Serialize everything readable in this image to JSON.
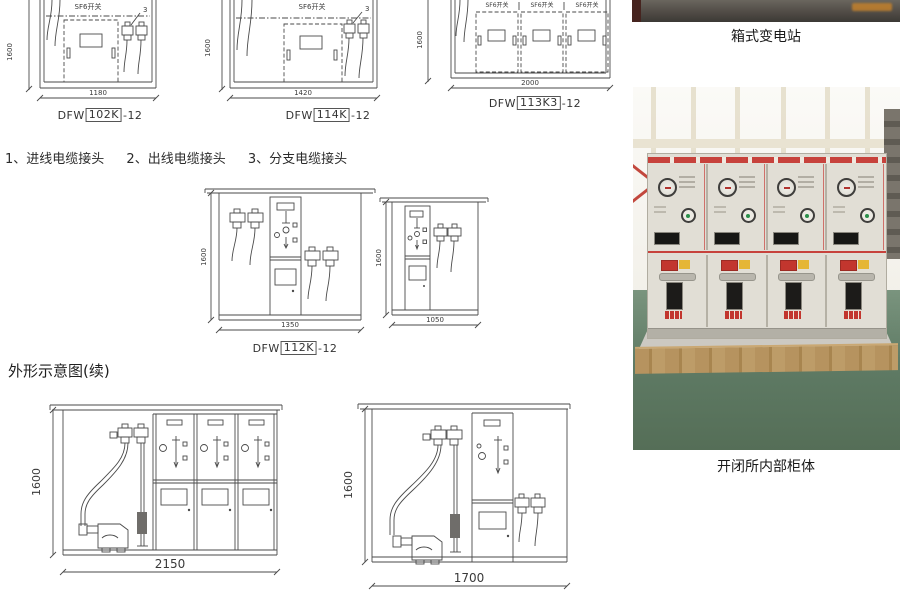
{
  "drawings": {
    "sf6_switch_label": "SF6开关",
    "height_dim": "1600",
    "callout_branch": "3",
    "legend_items": [
      "1、进线电缆接头",
      "2、出线电缆接头",
      "3、分支电缆接头"
    ],
    "section_title": "外形示意图(续)",
    "top_row": [
      {
        "width_dim": "1180",
        "model": {
          "prefix": "DFW",
          "boxed": "102K",
          "suffix": "-12"
        }
      },
      {
        "width_dim": "1420",
        "model": {
          "prefix": "DFW",
          "boxed": "114K",
          "suffix": "-12"
        }
      },
      {
        "width_dim": "2000",
        "model": {
          "prefix": "DFW",
          "boxed": "113K3",
          "suffix": "-12"
        }
      }
    ],
    "middle_row": [
      {
        "width_dim": "1350",
        "model": {
          "prefix": "DFW",
          "boxed": "112K",
          "suffix": "-12"
        }
      },
      {
        "width_dim": "1050"
      }
    ],
    "bottom_row": [
      {
        "width_dim": "2150"
      },
      {
        "width_dim": "1700"
      }
    ]
  },
  "photos": {
    "top_photo_caption": "箱式变电站",
    "main_photo_caption": "开闭所内部柜体"
  },
  "colors": {
    "line": "#4a4a4a",
    "accent_red": "#c7423c",
    "cabinet_beige": "#e1ded5",
    "floor_green": "#5f7b65",
    "wood_tan": "#b6935f",
    "watermark_orange": "#c8832a"
  }
}
